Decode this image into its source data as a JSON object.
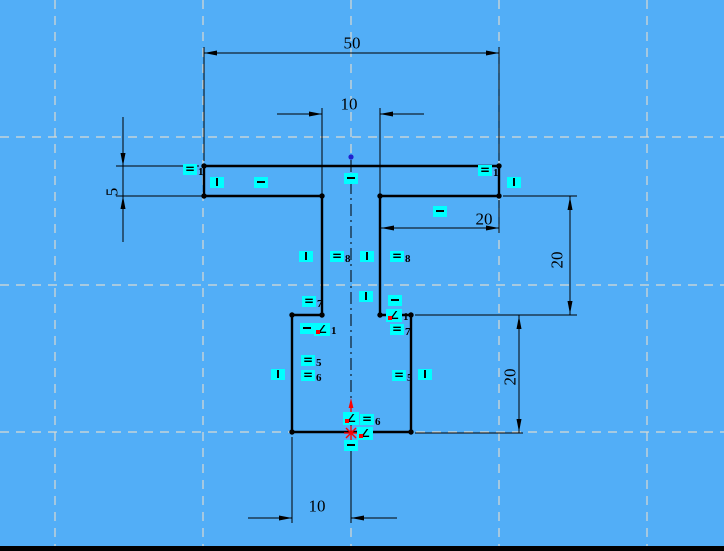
{
  "app": {
    "type_hint": "CAD sketch canvas",
    "colors": {
      "canvas-bg": "#52AEF7",
      "grid": "#DADAD2",
      "geometry": "#000000",
      "constraint-bg": "#00FFFF",
      "highlight": "#FF0000",
      "origin": "#2121CE",
      "bottom-bar": "#000000"
    }
  },
  "sketch": {
    "dimensions": [
      {
        "name": "overall-width-top",
        "value": "50"
      },
      {
        "name": "slot-width-top",
        "value": "10"
      },
      {
        "name": "flange-thickness-left",
        "value": "5"
      },
      {
        "name": "flange-right-length",
        "value": "20"
      },
      {
        "name": "stem-upper-height-right",
        "value": "20"
      },
      {
        "name": "base-height-right",
        "value": "20"
      },
      {
        "name": "base-half-width-bottom",
        "value": "10"
      }
    ],
    "constraints": [
      {
        "type": "equal",
        "label": "1",
        "x": 190,
        "y": 169
      },
      {
        "type": "equal",
        "label": "1",
        "x": 485,
        "y": 170
      },
      {
        "type": "vertical",
        "label": "",
        "x": 217,
        "y": 182
      },
      {
        "type": "horizontal",
        "label": "",
        "x": 261,
        "y": 182
      },
      {
        "type": "horizontal",
        "label": "",
        "x": 351,
        "y": 178
      },
      {
        "type": "vertical",
        "label": "",
        "x": 514,
        "y": 182
      },
      {
        "type": "horizontal",
        "label": "",
        "x": 440,
        "y": 211
      },
      {
        "type": "vertical",
        "label": "",
        "x": 306,
        "y": 256
      },
      {
        "type": "equal",
        "label": "8",
        "x": 337,
        "y": 256
      },
      {
        "type": "vertical",
        "label": "",
        "x": 367,
        "y": 256
      },
      {
        "type": "equal",
        "label": "8",
        "x": 397,
        "y": 256
      },
      {
        "type": "vertical",
        "label": "",
        "x": 366,
        "y": 296
      },
      {
        "type": "equal",
        "label": "7",
        "x": 309,
        "y": 301
      },
      {
        "type": "horizontal",
        "label": "",
        "x": 395,
        "y": 300
      },
      {
        "type": "horizontal",
        "label": "",
        "x": 307,
        "y": 328
      },
      {
        "type": "angle",
        "label": "1",
        "x": 322,
        "y": 329
      },
      {
        "type": "angle",
        "label": "1",
        "x": 394,
        "y": 315
      },
      {
        "type": "equal",
        "label": "7",
        "x": 397,
        "y": 329
      },
      {
        "type": "equal",
        "label": "5",
        "x": 308,
        "y": 360
      },
      {
        "type": "equal",
        "label": "6",
        "x": 308,
        "y": 375
      },
      {
        "type": "vertical",
        "label": "",
        "x": 278,
        "y": 374
      },
      {
        "type": "equal",
        "label": "5",
        "x": 399,
        "y": 375
      },
      {
        "type": "vertical",
        "label": "",
        "x": 425,
        "y": 374
      },
      {
        "type": "angle",
        "label": "",
        "x": 351,
        "y": 418
      },
      {
        "type": "equal",
        "label": "6",
        "x": 367,
        "y": 419
      },
      {
        "type": "angle",
        "label": "",
        "x": 365,
        "y": 433
      },
      {
        "type": "horizontal",
        "label": "",
        "x": 351,
        "y": 445
      }
    ]
  }
}
